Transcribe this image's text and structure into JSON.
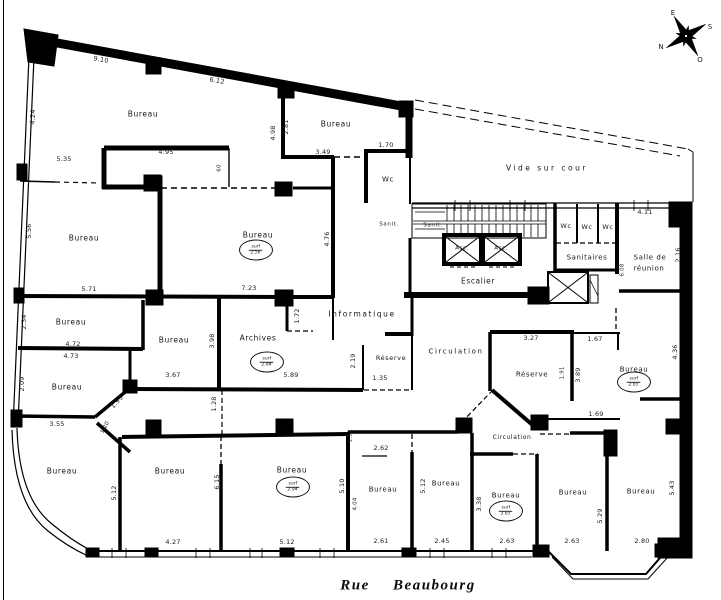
{
  "street": {
    "text": "Rue Beaubourg"
  },
  "compass": {
    "e": "E",
    "s": "S",
    "n": "N",
    "o": "O"
  },
  "labels": [
    {
      "name": "room-bureau-top-left",
      "text": "Bureau",
      "x": 143,
      "y": 114,
      "cls": "room"
    },
    {
      "name": "room-bureau-top-mid",
      "text": "Bureau",
      "x": 336,
      "y": 124,
      "cls": "room"
    },
    {
      "name": "room-wc-top",
      "text": "Wc",
      "x": 388,
      "y": 180,
      "cls": "room",
      "size": 7
    },
    {
      "name": "vide-sur-cour",
      "text": "Vide sur cour",
      "x": 547,
      "y": 168,
      "cls": "vide"
    },
    {
      "name": "room-bureau-center",
      "text": "Bureau",
      "x": 258,
      "y": 235,
      "cls": "room"
    },
    {
      "name": "room-bureau-left-1",
      "text": "Bureau",
      "x": 84,
      "y": 238,
      "cls": "room"
    },
    {
      "name": "room-escalier",
      "text": "Escalier",
      "x": 478,
      "y": 281,
      "cls": "room",
      "size": 7.5
    },
    {
      "name": "room-asc-1",
      "text": "Asc.",
      "x": 462,
      "y": 249,
      "cls": "room",
      "size": 5.5
    },
    {
      "name": "room-asc-2",
      "text": "Asc.",
      "x": 501,
      "y": 249,
      "cls": "room",
      "size": 5.5
    },
    {
      "name": "room-sanit-1",
      "text": "Sanit.",
      "x": 389,
      "y": 225,
      "cls": "room",
      "size": 5.5
    },
    {
      "name": "room-sanit-2",
      "text": "Sanit.",
      "x": 433,
      "y": 226,
      "cls": "room",
      "size": 5.5
    },
    {
      "name": "room-wc-1",
      "text": "Wc",
      "x": 566,
      "y": 226,
      "cls": "room",
      "size": 6.5
    },
    {
      "name": "room-wc-2",
      "text": "Wc",
      "x": 587,
      "y": 227,
      "cls": "room",
      "size": 6.5
    },
    {
      "name": "room-wc-3",
      "text": "Wc",
      "x": 608,
      "y": 227,
      "cls": "room",
      "size": 6.5
    },
    {
      "name": "room-sanitaires",
      "text": "Sanitaires",
      "x": 587,
      "y": 258,
      "cls": "room",
      "size": 7
    },
    {
      "name": "room-salle-reunion-l1",
      "text": "Salle de",
      "x": 650,
      "y": 258,
      "cls": "room",
      "size": 7
    },
    {
      "name": "room-salle-reunion-l2",
      "text": "réunion",
      "x": 649,
      "y": 269,
      "cls": "room",
      "size": 7
    },
    {
      "name": "room-circulation-1",
      "text": "Circulation",
      "x": 456,
      "y": 352,
      "cls": "room spaced",
      "size": 7
    },
    {
      "name": "room-reserve-1",
      "text": "Réserve",
      "x": 532,
      "y": 375,
      "cls": "room",
      "size": 7
    },
    {
      "name": "room-informatique",
      "text": "Informatique",
      "x": 362,
      "y": 314,
      "cls": "room spaced",
      "size": 7.5
    },
    {
      "name": "room-reserve-2",
      "text": "Réserve",
      "x": 391,
      "y": 358,
      "cls": "room",
      "size": 6.5
    },
    {
      "name": "room-archives",
      "text": "Archives",
      "x": 258,
      "y": 338,
      "cls": "room",
      "size": 7.5
    },
    {
      "name": "room-bureau-left-2",
      "text": "Bureau",
      "x": 71,
      "y": 322,
      "cls": "room"
    },
    {
      "name": "room-bureau-left-3",
      "text": "Bureau",
      "x": 67,
      "y": 387,
      "cls": "room"
    },
    {
      "name": "room-bureau-mid",
      "text": "Bureau",
      "x": 174,
      "y": 340,
      "cls": "room"
    },
    {
      "name": "room-bureau-bl-1",
      "text": "Bureau",
      "x": 62,
      "y": 471,
      "cls": "room"
    },
    {
      "name": "room-bureau-bl-2",
      "text": "Bureau",
      "x": 170,
      "y": 471,
      "cls": "room"
    },
    {
      "name": "room-bureau-bot-center",
      "text": "Bureau",
      "x": 292,
      "y": 470,
      "cls": "room"
    },
    {
      "name": "room-bureau-bot-3",
      "text": "Bureau",
      "x": 383,
      "y": 490,
      "cls": "room",
      "size": 7
    },
    {
      "name": "room-bureau-bot-4",
      "text": "Bureau",
      "x": 446,
      "y": 484,
      "cls": "room",
      "size": 7
    },
    {
      "name": "room-bureau-bot-5",
      "text": "Bureau",
      "x": 506,
      "y": 496,
      "cls": "room",
      "size": 7
    },
    {
      "name": "room-bureau-bot-6",
      "text": "Bureau",
      "x": 573,
      "y": 493,
      "cls": "room",
      "size": 7
    },
    {
      "name": "room-bureau-bot-7",
      "text": "Bureau",
      "x": 641,
      "y": 492,
      "cls": "room",
      "size": 7
    },
    {
      "name": "room-bureau-right",
      "text": "Bureau",
      "x": 634,
      "y": 370,
      "cls": "room",
      "size": 7
    },
    {
      "name": "room-circulation-2",
      "text": "Circulation",
      "x": 512,
      "y": 438,
      "cls": "room",
      "size": 6
    },
    {
      "name": "dim-9-10",
      "text": "9.10",
      "x": 101,
      "y": 60,
      "cls": "dim",
      "rot": 10
    },
    {
      "name": "dim-6-12",
      "text": "6.12",
      "x": 217,
      "y": 81,
      "cls": "dim",
      "rot": 10
    },
    {
      "name": "dim-4-24",
      "text": "4.24",
      "x": 33,
      "y": 117,
      "cls": "dim",
      "rot": -87
    },
    {
      "name": "dim-5-35",
      "text": "5.35",
      "x": 64,
      "y": 159,
      "cls": "dim"
    },
    {
      "name": "dim-4-95",
      "text": "4.95",
      "x": 166,
      "y": 152,
      "cls": "dim"
    },
    {
      "name": "dim-60",
      "text": "60",
      "x": 220,
      "y": 168,
      "cls": "dim",
      "rot": -90,
      "size": 5.5
    },
    {
      "name": "dim-2-81",
      "text": "2.81",
      "x": 286,
      "y": 127,
      "cls": "dim",
      "rot": -90
    },
    {
      "name": "dim-4-98",
      "text": "4.98",
      "x": 273,
      "y": 133,
      "cls": "dim",
      "rot": -90
    },
    {
      "name": "dim-3-49",
      "text": "3.49",
      "x": 323,
      "y": 152,
      "cls": "dim"
    },
    {
      "name": "dim-1-70",
      "text": "1.70",
      "x": 386,
      "y": 145,
      "cls": "dim"
    },
    {
      "name": "dim-4-76",
      "text": "4.76",
      "x": 327,
      "y": 239,
      "cls": "dim",
      "rot": -90
    },
    {
      "name": "dim-7-23",
      "text": "7.23",
      "x": 249,
      "y": 288,
      "cls": "dim"
    },
    {
      "name": "dim-5-71",
      "text": "5.71",
      "x": 89,
      "y": 289,
      "cls": "dim"
    },
    {
      "name": "dim-5-56",
      "text": "5.56",
      "x": 29,
      "y": 231,
      "cls": "dim",
      "rot": -90
    },
    {
      "name": "dim-2-34",
      "text": "2.34",
      "x": 24,
      "y": 322,
      "cls": "dim",
      "rot": -90
    },
    {
      "name": "dim-4-72",
      "text": "4.72",
      "x": 73,
      "y": 344,
      "cls": "dim"
    },
    {
      "name": "dim-4-73",
      "text": "4.73",
      "x": 71,
      "y": 356,
      "cls": "dim"
    },
    {
      "name": "dim-2-09",
      "text": "2.09",
      "x": 22,
      "y": 384,
      "cls": "dim",
      "rot": -90
    },
    {
      "name": "dim-3-55",
      "text": "3.55",
      "x": 57,
      "y": 424,
      "cls": "dim"
    },
    {
      "name": "dim-1-93",
      "text": "1.93",
      "x": 117,
      "y": 402,
      "cls": "dim",
      "rot": -48
    },
    {
      "name": "dim-1-20",
      "text": "1.20",
      "x": 106,
      "y": 428,
      "cls": "dim",
      "rot": -62,
      "size": 5.5
    },
    {
      "name": "dim-3-98",
      "text": "3.98",
      "x": 212,
      "y": 341,
      "cls": "dim",
      "rot": -90
    },
    {
      "name": "dim-1-72",
      "text": "1.72",
      "x": 297,
      "y": 316,
      "cls": "dim",
      "rot": -90
    },
    {
      "name": "dim-5-89",
      "text": "5.89",
      "x": 291,
      "y": 375,
      "cls": "dim"
    },
    {
      "name": "dim-1-28",
      "text": "1.28",
      "x": 214,
      "y": 404,
      "cls": "dim",
      "rot": -90
    },
    {
      "name": "dim-3-67",
      "text": "3.67",
      "x": 173,
      "y": 375,
      "cls": "dim"
    },
    {
      "name": "dim-2-19",
      "text": "2.19",
      "x": 353,
      "y": 361,
      "cls": "dim",
      "rot": -90
    },
    {
      "name": "dim-1-35",
      "text": "1.35",
      "x": 380,
      "y": 378,
      "cls": "dim"
    },
    {
      "name": "dim-3-27",
      "text": "3.27",
      "x": 531,
      "y": 338,
      "cls": "dim"
    },
    {
      "name": "dim-1-67",
      "text": "1.67",
      "x": 595,
      "y": 339,
      "cls": "dim"
    },
    {
      "name": "dim-1-91",
      "text": "1.91",
      "x": 563,
      "y": 373,
      "cls": "dim",
      "rot": -90,
      "size": 5.5
    },
    {
      "name": "dim-3-89",
      "text": "3.89",
      "x": 578,
      "y": 375,
      "cls": "dim",
      "rot": -90
    },
    {
      "name": "dim-1-69",
      "text": "1.69",
      "x": 596,
      "y": 414,
      "cls": "dim"
    },
    {
      "name": "dim-4-11",
      "text": "4.11",
      "x": 645,
      "y": 212,
      "cls": "dim"
    },
    {
      "name": "dim-2-16",
      "text": "2.16",
      "x": 678,
      "y": 255,
      "cls": "dim",
      "rot": -90
    },
    {
      "name": "dim-6-08",
      "text": "6.08",
      "x": 623,
      "y": 270,
      "cls": "dim",
      "rot": -90,
      "size": 5.5
    },
    {
      "name": "dim-4-36",
      "text": "4.36",
      "x": 675,
      "y": 352,
      "cls": "dim",
      "rot": -90
    },
    {
      "name": "dim-5-12-a",
      "text": "5.12",
      "x": 114,
      "y": 493,
      "cls": "dim",
      "rot": -90
    },
    {
      "name": "dim-6-15",
      "text": "6.15",
      "x": 217,
      "y": 482,
      "cls": "dim",
      "rot": -90
    },
    {
      "name": "dim-4-27",
      "text": "4.27",
      "x": 173,
      "y": 542,
      "cls": "dim"
    },
    {
      "name": "dim-5-12-b",
      "text": "5.12",
      "x": 287,
      "y": 542,
      "cls": "dim"
    },
    {
      "name": "dim-5-10",
      "text": "5.10",
      "x": 342,
      "y": 486,
      "cls": "dim",
      "rot": -90
    },
    {
      "name": "dim-4-04",
      "text": "4.04",
      "x": 356,
      "y": 504,
      "cls": "dim",
      "rot": -90,
      "size": 5.5
    },
    {
      "name": "dim-1-51",
      "text": "1.51",
      "x": 351,
      "y": 436,
      "cls": "dim",
      "rot": -90,
      "size": 5.5
    },
    {
      "name": "dim-2-62",
      "text": "2.62",
      "x": 381,
      "y": 448,
      "cls": "dim"
    },
    {
      "name": "dim-2-61",
      "text": "2.61",
      "x": 381,
      "y": 541,
      "cls": "dim"
    },
    {
      "name": "dim-5-12-c",
      "text": "5.12",
      "x": 423,
      "y": 486,
      "cls": "dim",
      "rot": -90
    },
    {
      "name": "dim-2-45",
      "text": "2.45",
      "x": 442,
      "y": 541,
      "cls": "dim"
    },
    {
      "name": "dim-3-38",
      "text": "3.38",
      "x": 479,
      "y": 504,
      "cls": "dim",
      "rot": -90
    },
    {
      "name": "dim-2-63-a",
      "text": "2.63",
      "x": 507,
      "y": 541,
      "cls": "dim"
    },
    {
      "name": "dim-2-63-b",
      "text": "2.63",
      "x": 572,
      "y": 541,
      "cls": "dim"
    },
    {
      "name": "dim-5-29",
      "text": "5.29",
      "x": 600,
      "y": 516,
      "cls": "dim",
      "rot": -90
    },
    {
      "name": "dim-2-80",
      "text": "2.80",
      "x": 642,
      "y": 541,
      "cls": "dim"
    },
    {
      "name": "dim-5-43",
      "text": "5.43",
      "x": 672,
      "y": 488,
      "cls": "dim",
      "rot": -90
    }
  ],
  "badges": [
    {
      "name": "badge-bureau-center",
      "x": 256,
      "y": 250,
      "line1": "surf",
      "line2": "2.56"
    },
    {
      "name": "badge-archives",
      "x": 267,
      "y": 362,
      "line1": "surf",
      "line2": "2.84"
    },
    {
      "name": "badge-bureau-bot-center",
      "x": 293,
      "y": 487,
      "line1": "surf",
      "line2": "2.94"
    },
    {
      "name": "badge-bureau-bot-5",
      "x": 506,
      "y": 511,
      "line1": "surf",
      "line2": "3.65"
    },
    {
      "name": "badge-bureau-right",
      "x": 634,
      "y": 382,
      "line1": "surf",
      "line2": "2.65"
    }
  ]
}
